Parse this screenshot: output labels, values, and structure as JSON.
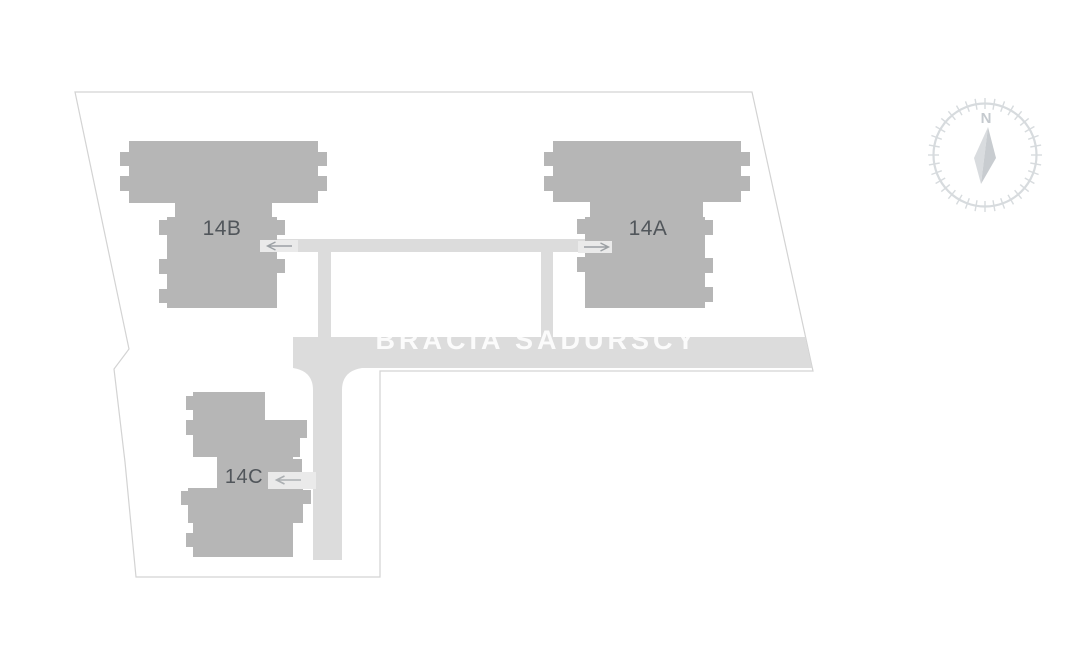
{
  "site_plan": {
    "street_label": "BRACIA SADURSCY",
    "buildings": [
      {
        "id": "14A",
        "label": "14A"
      },
      {
        "id": "14B",
        "label": "14B"
      },
      {
        "id": "14C",
        "label": "14C"
      }
    ],
    "entrance_arrows": [
      {
        "building": "14B",
        "direction": "left"
      },
      {
        "building": "14A",
        "direction": "right"
      },
      {
        "building": "14C",
        "direction": "left"
      }
    ],
    "compass": {
      "north_label": "N"
    },
    "colors": {
      "background": "#ffffff",
      "building": "#b6b6b6",
      "road": "#dcdcdc",
      "entry_path": "#eaeaea",
      "plot_boundary": "#d3d3d3",
      "building_label_text": "#51565b",
      "street_label_text": "#f7f7f7",
      "arrow": "#9ba0a4",
      "compass": "#d7dbde"
    }
  }
}
